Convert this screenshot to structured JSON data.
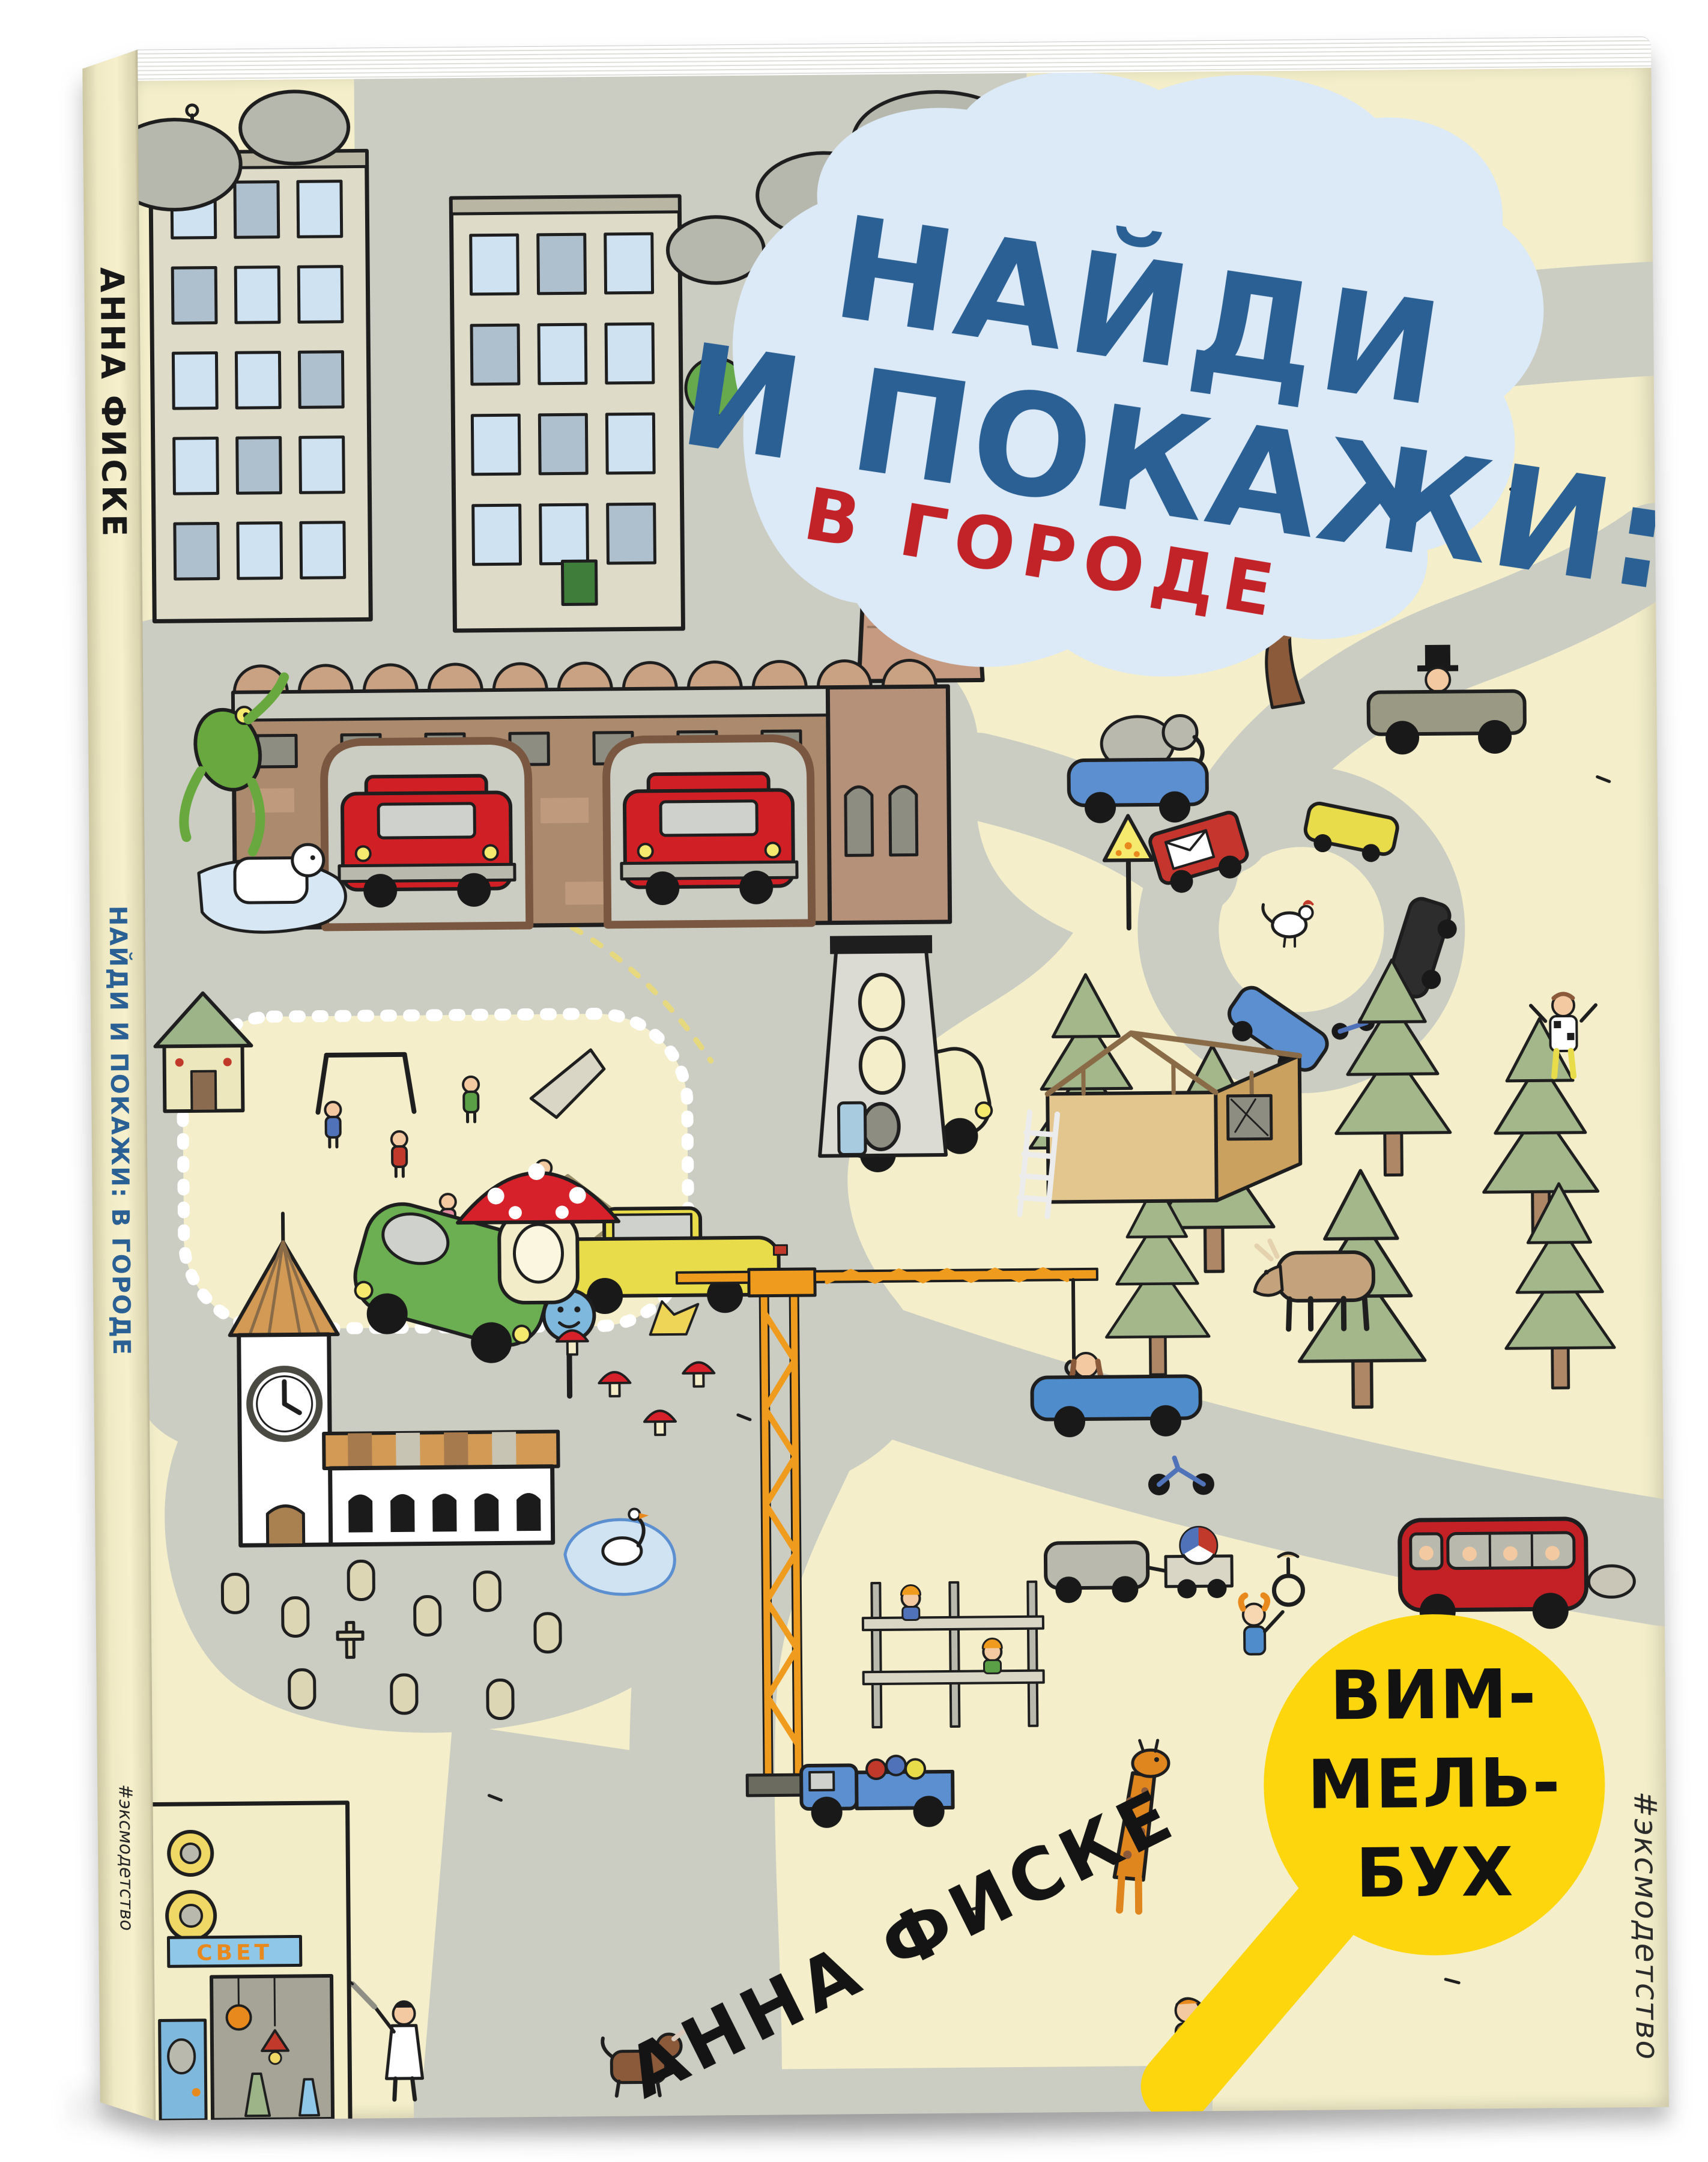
{
  "book": {
    "front_cover": {
      "title_line1": "НАЙДИ",
      "title_line2": "И ПОКАЖИ:",
      "subtitle": "В ГОРОДЕ",
      "author": "АННА ФИСКЕ",
      "series_badge": {
        "line1": "ВИМ-",
        "line2": "МЕЛЬ-",
        "line3": "БУХ"
      },
      "publisher_hashtag": "#эксмодетство",
      "shop_sign_text": "СВЕТ"
    },
    "spine": {
      "author": "АННА ФИСКЕ",
      "title": "НАЙДИ И ПОКАЖИ: В ГОРОДЕ",
      "publisher_hashtag": "#эксмодетство"
    },
    "colors": {
      "cover_background": "#f4efca",
      "title_blue": "#2b6094",
      "subtitle_red": "#c22329",
      "title_cloud_blue": "#dce9f6",
      "road_gray": "#cbcdc3",
      "badge_yellow": "#fdd60e",
      "fire_truck_red": "#d02026",
      "crane_orange": "#ef9b1d",
      "shop_sign_blue": "#8fc7e8",
      "shop_sign_orange": "#e8891e"
    },
    "scene_elements": [
      "apartment-buildings",
      "factory-chimney",
      "smoke-clouds",
      "fire-station",
      "fire-trucks",
      "frog",
      "dog-on-ice",
      "playhouse",
      "playground",
      "swing",
      "slide",
      "sandbox",
      "children",
      "green-car",
      "cream-car",
      "yellow-taxi",
      "smiley-road-sign",
      "fly-agaric-mushroom",
      "small-mushrooms",
      "chanterelle",
      "climbing-tower",
      "loop-road",
      "mail-truck",
      "loop-cars",
      "rooster",
      "pizza-road-sign",
      "car-with-elephant",
      "oldtimer-car",
      "apple-tree",
      "pine-trees",
      "moose",
      "house-under-construction",
      "ladder",
      "checkered-man",
      "church-with-clock",
      "graveyard",
      "pond-with-swan",
      "construction-crane",
      "scaffolding-workers",
      "blue-truck",
      "red-bus",
      "blue-convertible",
      "motorcycle",
      "car-with-trailer",
      "clown-with-unicycle",
      "giraffe",
      "walking-boy",
      "doctor",
      "brown-dog",
      "lamp-shop"
    ]
  }
}
